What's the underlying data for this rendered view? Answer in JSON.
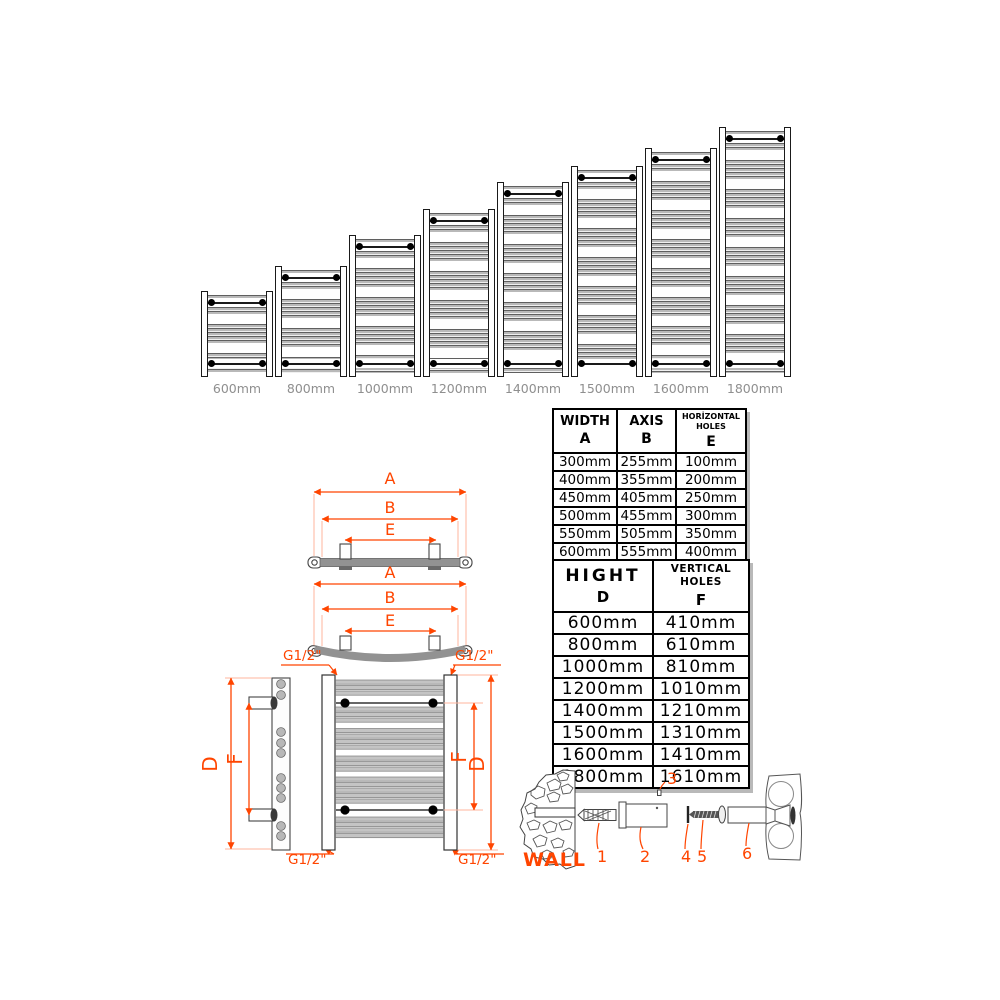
{
  "colors": {
    "accent": "#ff4500",
    "bar_gray": "#b9b9b9",
    "label_gray": "#8f8f8f",
    "line_black": "#000000"
  },
  "radiator_row": {
    "items": [
      {
        "label": "600mm",
        "height_px": 86
      },
      {
        "label": "800mm",
        "height_px": 111
      },
      {
        "label": "1000mm",
        "height_px": 142
      },
      {
        "label": "1200mm",
        "height_px": 168
      },
      {
        "label": "1400mm",
        "height_px": 195
      },
      {
        "label": "1500mm",
        "height_px": 211
      },
      {
        "label": "1600mm",
        "height_px": 229
      },
      {
        "label": "1800mm",
        "height_px": 250
      }
    ]
  },
  "size_table": {
    "col_headers": [
      {
        "title": "WIDTH",
        "letter": "A"
      },
      {
        "title": "AXIS",
        "letter": "B"
      },
      {
        "title": "HORİZONTAL HOLES",
        "letter": "E"
      }
    ],
    "rows": [
      [
        "300mm",
        "255mm",
        "100mm"
      ],
      [
        "400mm",
        "355mm",
        "200mm"
      ],
      [
        "450mm",
        "405mm",
        "250mm"
      ],
      [
        "500mm",
        "455mm",
        "300mm"
      ],
      [
        "550mm",
        "505mm",
        "350mm"
      ],
      [
        "600mm",
        "555mm",
        "400mm"
      ]
    ]
  },
  "height_table": {
    "col_headers": [
      {
        "title": "HIGHT",
        "letter": "D"
      },
      {
        "title": "VERTICAL HOLES",
        "letter": "F"
      }
    ],
    "rows": [
      [
        "600mm",
        "410mm"
      ],
      [
        "800mm",
        "610mm"
      ],
      [
        "1000mm",
        "810mm"
      ],
      [
        "1200mm",
        "1010mm"
      ],
      [
        "1400mm",
        "1210mm"
      ],
      [
        "1500mm",
        "1310mm"
      ],
      [
        "1600mm",
        "1410mm"
      ],
      [
        "1800mm",
        "1610mm"
      ]
    ]
  },
  "dimension_labels": {
    "A": "A",
    "B": "B",
    "E": "E",
    "D": "D",
    "F": "F",
    "thread": "G1/2\""
  },
  "hardware": {
    "wall_label": "WALL",
    "part_numbers": [
      "1",
      "2",
      "3",
      "4",
      "5",
      "6"
    ]
  }
}
